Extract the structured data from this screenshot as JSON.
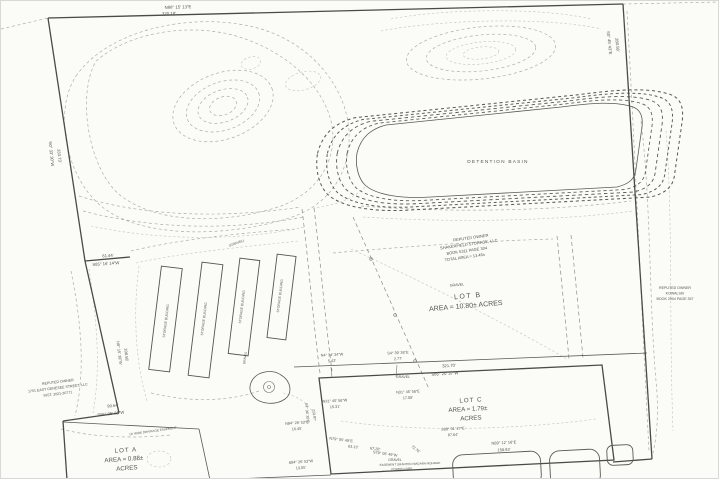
{
  "drawing": {
    "type": "survey-plat-site-plan",
    "background_color": "#fbfbf8",
    "boundary_color": "#4a4a46",
    "contour_color": "#aeaea8",
    "text_color": "#55544f"
  },
  "parcels": {
    "lot_a": {
      "title": "LOT A",
      "area": "AREA = 0.88±",
      "units": "ACRES"
    },
    "lot_b": {
      "title": "LOT B",
      "area": "AREA = 10.80± ACRES"
    },
    "lot_c": {
      "title": "LOT C",
      "area": "AREA = 1.79±",
      "units": "ACRES"
    }
  },
  "features": {
    "detention_basin": "DETENTION BASIN",
    "storage_building": "STORAGE BUILDING"
  },
  "labels": [
    {
      "name": "bearing-north-line",
      "text": "N88° 15' 13\"E",
      "x": 177,
      "y": 7.5,
      "size": 4.3,
      "rot": -1.5
    },
    {
      "name": "distance-north-line",
      "text": "320.18'",
      "x": 168,
      "y": 14,
      "size": 4.3,
      "rot": -1.5
    },
    {
      "name": "bearing-east-line",
      "text": "S0° 45' 43\"E",
      "x": 607,
      "y": 42,
      "size": 4.2,
      "rot": 84
    },
    {
      "name": "distance-east-line",
      "text": "280.56'",
      "x": 615,
      "y": 44,
      "size": 4.2,
      "rot": 84
    },
    {
      "name": "bearing-west-upper-line",
      "text": "N0° 33' 30\"W",
      "x": 49,
      "y": 153,
      "size": 4.2,
      "rot": 84
    },
    {
      "name": "distance-west-upper-line",
      "text": "333.73'",
      "x": 57,
      "y": 155,
      "size": 4.2,
      "rot": 84
    },
    {
      "name": "distance-west-jog",
      "text": "61.44'",
      "x": 107,
      "y": 256,
      "size": 4.2,
      "rot": -4
    },
    {
      "name": "bearing-west-jog",
      "text": "S85° 16' 14\"W",
      "x": 105,
      "y": 264,
      "size": 4.2,
      "rot": -4
    },
    {
      "name": "owner-center-line1",
      "text": "REPUTED OWNER",
      "x": 470,
      "y": 238,
      "size": 4,
      "rot": -8
    },
    {
      "name": "owner-center-line2",
      "text": "SHAKERFIELD STORAGE, LLC",
      "x": 468,
      "y": 244.5,
      "size": 4,
      "rot": -8
    },
    {
      "name": "owner-center-line3",
      "text": "BOOK 5311 PAGE 304",
      "x": 466,
      "y": 251,
      "size": 4,
      "rot": -8
    },
    {
      "name": "owner-center-line4",
      "text": "TOTAL AREA = 13.46±",
      "x": 464,
      "y": 257.5,
      "size": 4,
      "rot": -8
    },
    {
      "name": "gravel-label-lotb",
      "text": "GRAVEL",
      "x": 456,
      "y": 285,
      "size": 3.6,
      "rot": -5
    },
    {
      "name": "lot-b-title",
      "text": "LOT B",
      "x": 467,
      "y": 297,
      "size": 7,
      "rot": -5,
      "ls": 1.5
    },
    {
      "name": "lot-b-area",
      "text": "AREA = 10.80± ACRES",
      "x": 465,
      "y": 307,
      "size": 7,
      "rot": -5
    },
    {
      "name": "owner-right-line1",
      "text": "REPUTED OWNER",
      "x": 674,
      "y": 288,
      "size": 3.6
    },
    {
      "name": "owner-right-line2",
      "text": "KOWALSKI",
      "x": 674,
      "y": 293.5,
      "size": 3.6
    },
    {
      "name": "owner-right-line3",
      "text": "BOOK 2904 PAGE 357",
      "x": 674,
      "y": 299,
      "size": 3.6
    },
    {
      "name": "owner-left-line1",
      "text": "REPUTED OWNER",
      "x": 57,
      "y": 382,
      "size": 3.6,
      "rot": -7
    },
    {
      "name": "owner-left-line2",
      "text": "1701 EAST GENESEE STREET, LLC",
      "x": 57,
      "y": 388,
      "size": 3.6,
      "rot": -7
    },
    {
      "name": "owner-left-line3",
      "text": "INST. 2021-30771",
      "x": 57,
      "y": 394,
      "size": 3.6,
      "rot": -7
    },
    {
      "name": "bearing-west-mid-line",
      "text": "N0° 15' 39\"W",
      "x": 117,
      "y": 352,
      "size": 4,
      "rot": 83
    },
    {
      "name": "distance-west-mid-line",
      "text": "208.58'",
      "x": 124,
      "y": 354,
      "size": 4,
      "rot": 83
    },
    {
      "name": "distance-lota-north",
      "text": "90.64'",
      "x": 112,
      "y": 406,
      "size": 4.2,
      "rot": -6
    },
    {
      "name": "bearing-lota-north",
      "text": "S86° 05' 21\"W",
      "x": 110,
      "y": 414,
      "size": 4.2,
      "rot": -6
    },
    {
      "name": "drainage-easement-note",
      "text": "10' WIDE DRAINAGE EASEMENT",
      "x": 152,
      "y": 431,
      "size": 3.1,
      "rot": -8
    },
    {
      "name": "lot-a-title",
      "text": "LOT A",
      "x": 125,
      "y": 451,
      "size": 6.2,
      "rot": -4,
      "ls": 1
    },
    {
      "name": "lot-a-area",
      "text": "AREA = 0.88±",
      "x": 123,
      "y": 460,
      "size": 6.2,
      "rot": -4
    },
    {
      "name": "lot-a-units",
      "text": "ACRES",
      "x": 126,
      "y": 469,
      "size": 6.2,
      "rot": -4
    },
    {
      "name": "detention-basin-label",
      "text": "DETENTION BASIN",
      "x": 497,
      "y": 162,
      "size": 4.8,
      "ls": 1.2
    },
    {
      "name": "storage-building-label-1",
      "text": "STORAGE BUILDING",
      "x": 166,
      "y": 320,
      "size": 3.4,
      "rot": -83
    },
    {
      "name": "storage-building-label-2",
      "text": "STORAGE BUILDING",
      "x": 204,
      "y": 318,
      "size": 3.4,
      "rot": -83
    },
    {
      "name": "storage-building-label-3",
      "text": "STORAGE BUILDING",
      "x": 242,
      "y": 306,
      "size": 3.4,
      "rot": -83
    },
    {
      "name": "storage-building-label-4",
      "text": "STORAGE BUILDING",
      "x": 280,
      "y": 295,
      "size": 3.4,
      "rot": -83
    },
    {
      "name": "gravel-label-yard",
      "text": "(GRAVEL)",
      "x": 236,
      "y": 243,
      "size": 3.4,
      "rot": -20
    },
    {
      "name": "gravel-label-drive",
      "text": "GRAVEL",
      "x": 245,
      "y": 357,
      "size": 3.2,
      "rot": -83
    },
    {
      "name": "gravel-label-lotc-north",
      "text": "GRAVEL",
      "x": 402,
      "y": 377,
      "size": 3.6
    },
    {
      "name": "gravel-label-lotc-south",
      "text": "GRAVEL",
      "x": 394,
      "y": 460,
      "size": 3.4
    },
    {
      "name": "bearing-connector-west",
      "text": "N4° 34' 34\"W",
      "x": 331,
      "y": 355,
      "size": 3.8,
      "rot": -3
    },
    {
      "name": "distance-connector-west",
      "text": "5.43'",
      "x": 331,
      "y": 361,
      "size": 3.8,
      "rot": -3
    },
    {
      "name": "bearing-connector-east",
      "text": "S4° 39' 26\"E",
      "x": 397,
      "y": 353,
      "size": 3.8,
      "rot": -3
    },
    {
      "name": "distance-connector-east",
      "text": "2.77'",
      "x": 397,
      "y": 359,
      "size": 3.8,
      "rot": -3
    },
    {
      "name": "distance-lotc-north",
      "text": "321.70'",
      "x": 448,
      "y": 366,
      "size": 4.2,
      "rot": -3
    },
    {
      "name": "bearing-lotc-north",
      "text": "S85° 20' 37\"W",
      "x": 444,
      "y": 374,
      "size": 4.2,
      "rot": -3
    },
    {
      "name": "bearing-lotc-nw1",
      "text": "N31° 45' 56\"E",
      "x": 407,
      "y": 392,
      "size": 3.8,
      "rot": -3
    },
    {
      "name": "distance-lotc-nw1",
      "text": "17.08'",
      "x": 407,
      "y": 398,
      "size": 3.8,
      "rot": -3
    },
    {
      "name": "lot-c-title",
      "text": "LOT C",
      "x": 470,
      "y": 401,
      "size": 6.2,
      "rot": -3,
      "ls": 1
    },
    {
      "name": "lot-c-area",
      "text": "AREA = 1.79±",
      "x": 467,
      "y": 410,
      "size": 6.2,
      "rot": -3
    },
    {
      "name": "lot-c-units",
      "text": "ACRES",
      "x": 470,
      "y": 419,
      "size": 6.2,
      "rot": -3
    },
    {
      "name": "bearing-lotc-nw2",
      "text": "N31° 45' 56\"W",
      "x": 334,
      "y": 401,
      "size": 3.8,
      "rot": -3
    },
    {
      "name": "distance-lotc-nw2",
      "text": "15.31'",
      "x": 334,
      "y": 407,
      "size": 3.8,
      "rot": -3
    },
    {
      "name": "bearing-lotc-west",
      "text": "S4° 36' 35\"E",
      "x": 305,
      "y": 412,
      "size": 3.6,
      "rot": 84
    },
    {
      "name": "distance-lotc-west",
      "text": "223.97'",
      "x": 312,
      "y": 414,
      "size": 3.6,
      "rot": 84
    },
    {
      "name": "bearing-sw-1",
      "text": "N84° 26' 53\"E",
      "x": 296,
      "y": 423,
      "size": 3.8,
      "rot": -4
    },
    {
      "name": "distance-sw-1",
      "text": "16.45'",
      "x": 296,
      "y": 429,
      "size": 3.8,
      "rot": -4
    },
    {
      "name": "bearing-south-1",
      "text": "N79° 05' 49\"E",
      "x": 340,
      "y": 440,
      "size": 3.8,
      "rot": 7
    },
    {
      "name": "distance-south-1",
      "text": "63.13'",
      "x": 352,
      "y": 447,
      "size": 3.8,
      "rot": 7
    },
    {
      "name": "distance-south-2",
      "text": "67.28'",
      "x": 374,
      "y": 449,
      "size": 3.8,
      "rot": 7
    },
    {
      "name": "bearing-south-2",
      "text": "S79° 05' 49\"W",
      "x": 384,
      "y": 454,
      "size": 3.8,
      "rot": 8
    },
    {
      "name": "distance-south-3",
      "text": "72.76'",
      "x": 414,
      "y": 449,
      "size": 3.8,
      "rot": 38
    },
    {
      "name": "bearing-sw-2",
      "text": "S84° 26' 53\"W",
      "x": 300,
      "y": 462,
      "size": 3.8,
      "rot": -4
    },
    {
      "name": "distance-sw-2",
      "text": "13.05'",
      "x": 300,
      "y": 468,
      "size": 3.8,
      "rot": -4
    },
    {
      "name": "bearing-lotc-mid",
      "text": "S89° 01' 27\"E",
      "x": 452,
      "y": 429,
      "size": 3.8,
      "rot": -3
    },
    {
      "name": "distance-lotc-mid",
      "text": "87.64'",
      "x": 452,
      "y": 435,
      "size": 3.8,
      "rot": -3
    },
    {
      "name": "bearing-lotc-south",
      "text": "N89° 12' 16\"E",
      "x": 503,
      "y": 443,
      "size": 4,
      "rot": -3
    },
    {
      "name": "distance-lotc-south",
      "text": "158.63'",
      "x": 503,
      "y": 450,
      "size": 4,
      "rot": -3
    },
    {
      "name": "easement-note-line1",
      "text": "EASEMENT GRANTED NIAGARA MOHAWK",
      "x": 409,
      "y": 464,
      "size": 3,
      "rot": -2
    },
    {
      "name": "easement-note-line2",
      "text": "POWER CORP.",
      "x": 401,
      "y": 469,
      "size": 3,
      "rot": -2
    }
  ]
}
